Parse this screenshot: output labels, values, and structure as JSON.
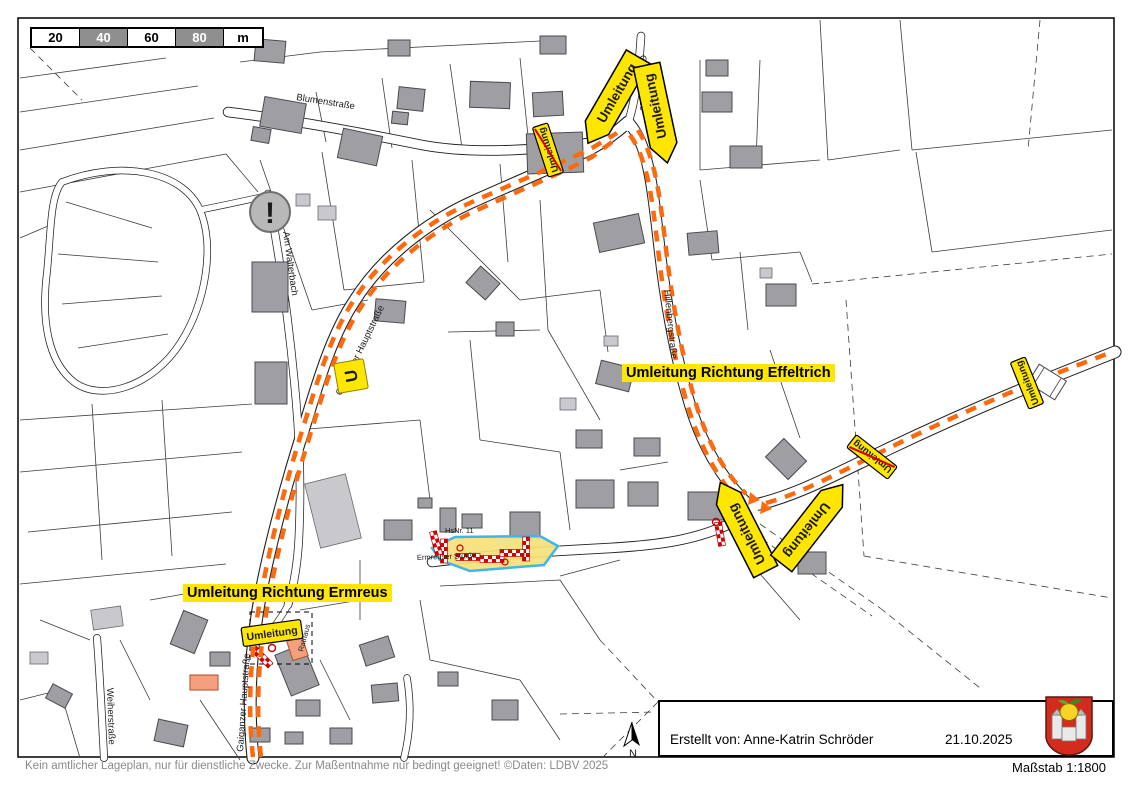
{
  "map": {
    "route_labels": {
      "effeltrich": "Umleitung Richtung Effeltrich",
      "ermreus": "Umleitung Richtung Ermreus"
    },
    "sign_text": "Umleitung",
    "u_shield": "U",
    "alert_mark": "!",
    "compass_n": "N",
    "streets": {
      "blumenstrasse": "Blumenstraße",
      "gartenstrasse": "Gartenstraße",
      "am_walterbach": "Am Walterbach",
      "hauptstrasse": "Gaiganzer Hauptstraße",
      "hillenbergstrasse": "Hillenbergstraße",
      "weiherstrasse": "Weiherstraße",
      "ermreuser": "Ermreuser Straße",
      "house_number": "HsNr. 11",
      "rathaus": "Rathaus"
    }
  },
  "scale_bar": {
    "ticks": [
      "20",
      "40",
      "60",
      "80"
    ],
    "unit": "m"
  },
  "footer": {
    "disclaimer": "Kein amtlicher Lageplan, nur für dienstliche Zwecke. Zur Maßentnahme nur bedingt geeignet! ©Daten: LDBV 2025",
    "scale": "Maßstab 1:1800"
  },
  "info_box": {
    "created_by": "Erstellt von: Anne-Katrin Schröder",
    "date": "21.10.2025"
  },
  "colors": {
    "detour_route": "#fb6a0e",
    "sign_yellow": "#ffe600",
    "struck_red": "#d40000",
    "building_gray": "#9e9ea3",
    "building_light": "#c9c9cd",
    "highlight_building": "#f4a07e",
    "construction_fill": "#f6e07a",
    "construction_border": "#3fb6ea",
    "crest_red": "#d52b1e"
  }
}
